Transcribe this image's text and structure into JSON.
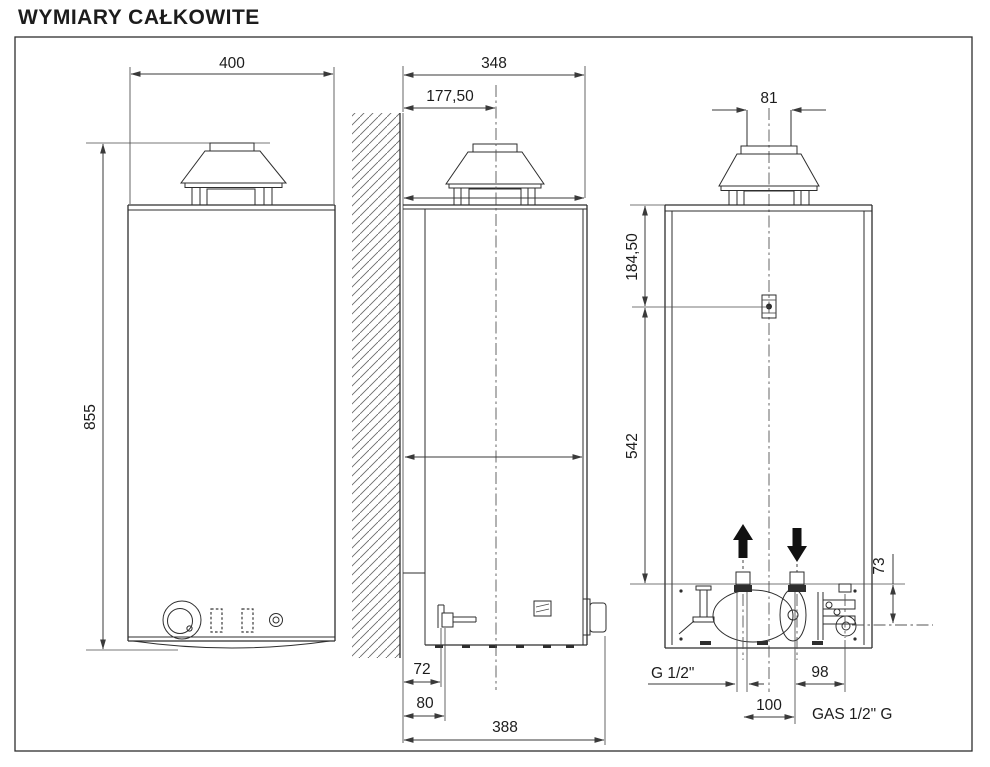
{
  "title": "WYMIARY CAŁKOWITE",
  "drawing": {
    "front_view": {
      "width": "400",
      "height": "855"
    },
    "side_view": {
      "depth": "348",
      "flue_axis_offset": "177,50",
      "drain_offset": "72",
      "pipe_offset": "80",
      "overall_depth": "388"
    },
    "rear_view": {
      "flue_diameter": "81",
      "top_to_bracket": "184,50",
      "bracket_to_connections": "542",
      "connections_height": "73",
      "water_connection": "G 1/2\"",
      "water_spacing": "100",
      "gas_spacing": "98",
      "gas_connection": "GAS 1/2\" G"
    }
  }
}
